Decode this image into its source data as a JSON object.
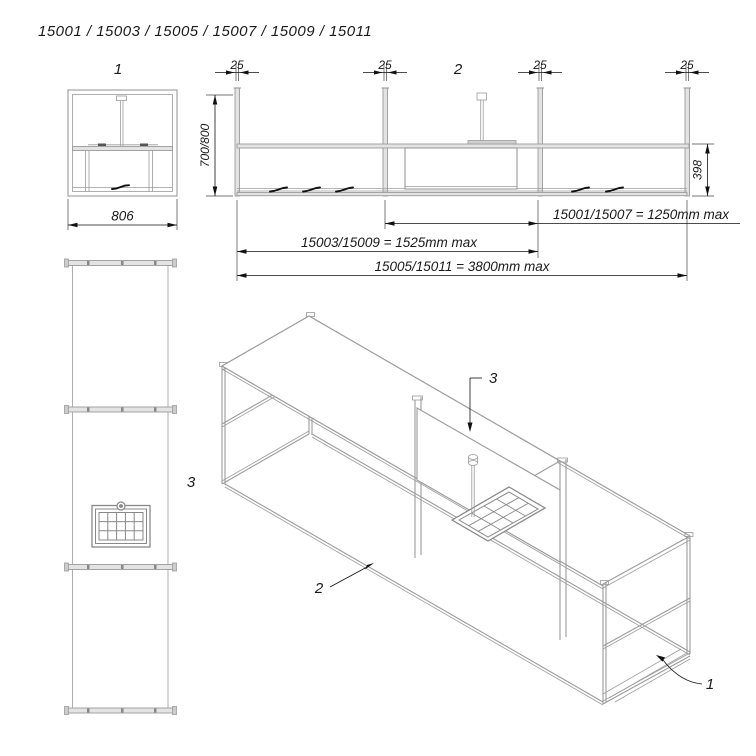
{
  "title": "15001 / 15003 / 15005 / 15007 / 15009 / 15011",
  "views": {
    "front": {
      "label": "1",
      "width_dim": "806"
    },
    "elevation": {
      "label": "2",
      "post_dim": "25",
      "height_dim": "700/800",
      "depth_dim": "398",
      "length_dims": [
        "15001/15007 = 1250mm max",
        "15003/15009 = 1525mm max",
        "15005/15011 = 3800mm max"
      ]
    },
    "plan": {
      "label": "3"
    },
    "iso": {
      "basket_label": "3",
      "rail_label": "2",
      "frame_label": "1"
    }
  },
  "colors": {
    "line": "#9b9b9b",
    "dim": "#1a1a1a",
    "background": "#ffffff"
  }
}
